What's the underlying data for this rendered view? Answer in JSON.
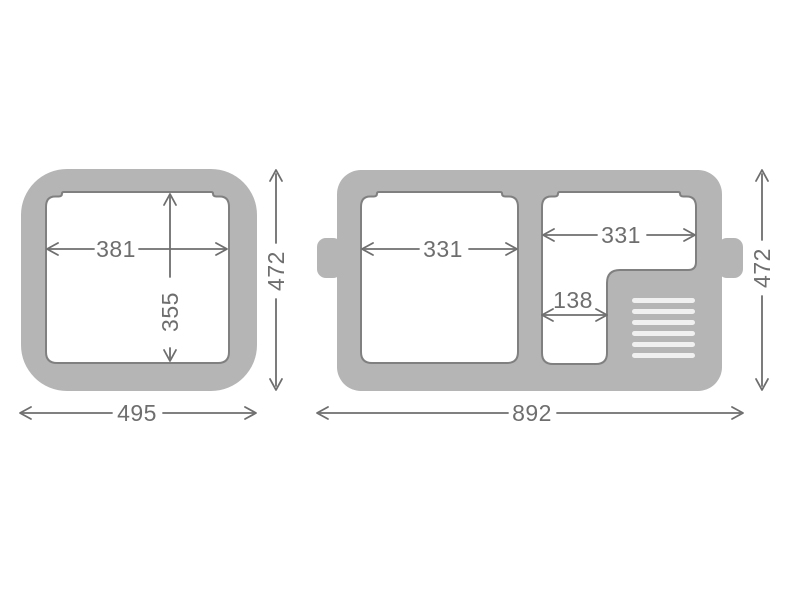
{
  "colors": {
    "background": "#ffffff",
    "body": "#b5b5b5",
    "compartment_fill": "#ffffff",
    "compartment_outline": "#808080",
    "vent_stripe": "#f0f0f0",
    "dimension": "#6e6e6e"
  },
  "left_unit": {
    "inner_width": "381",
    "inner_depth": "355",
    "outer_width": "495",
    "outer_depth": "472"
  },
  "right_unit": {
    "left_compartment_width": "331",
    "right_compartment_width": "331",
    "narrow_width": "138",
    "outer_width": "892",
    "outer_depth": "472"
  }
}
